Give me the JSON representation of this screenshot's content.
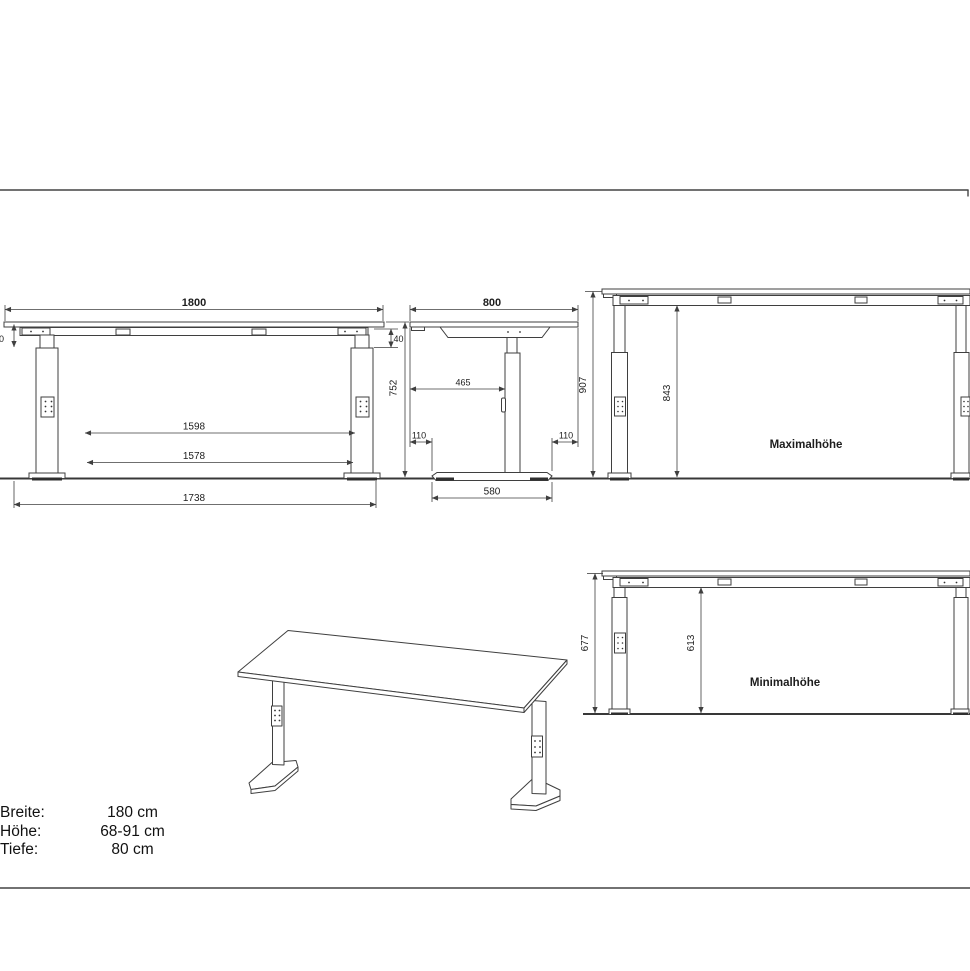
{
  "views": {
    "front": {
      "width": "1800",
      "rail_height_left": "40",
      "rail_height_right": "40",
      "height": "752",
      "inner_width_top": "1598",
      "inner_width_bottom": "1578",
      "foot_span": "1738"
    },
    "side": {
      "depth": "800",
      "top_to_column": "465",
      "front_overhang": "110",
      "back_overhang": "110",
      "base_length": "580"
    },
    "max_height": {
      "label": "Maximalhöhe",
      "total_height": "907",
      "under_frame_height": "843"
    },
    "min_height": {
      "label": "Minimalhöhe",
      "total_height": "677",
      "under_frame_height": "613"
    }
  },
  "specs": {
    "rows": [
      {
        "label": "Breite:",
        "value": "180 cm"
      },
      {
        "label": "Höhe:",
        "value": "68-91 cm"
      },
      {
        "label": "Tiefe:",
        "value": "80 cm"
      }
    ]
  },
  "colors": {
    "line": "#3f3f3f",
    "ground": "#383838",
    "pad": "#2f2f2f",
    "text": "#1d1d1d"
  }
}
